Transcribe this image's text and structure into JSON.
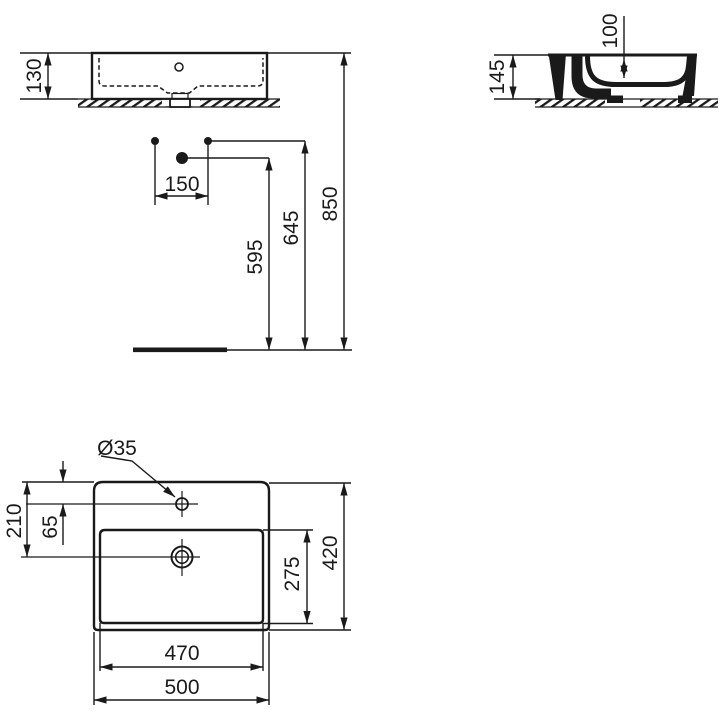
{
  "drawing": {
    "front_view": {
      "height": "130"
    },
    "side_view": {
      "total_height": "145",
      "basin_depth": "100"
    },
    "installation": {
      "hole_spacing": "150",
      "drain_height": "595",
      "fixing_holes_height": "645",
      "rim_height": "850"
    },
    "plan_view": {
      "faucet_hole_diameter": "Ø35",
      "outer_width": "500",
      "basin_width": "470",
      "outer_depth": "420",
      "basin_depth": "275",
      "drain_center_offset": "210",
      "faucet_center_offset": "65"
    }
  },
  "colors": {
    "line": "#1a1a1a",
    "background": "#ffffff"
  }
}
